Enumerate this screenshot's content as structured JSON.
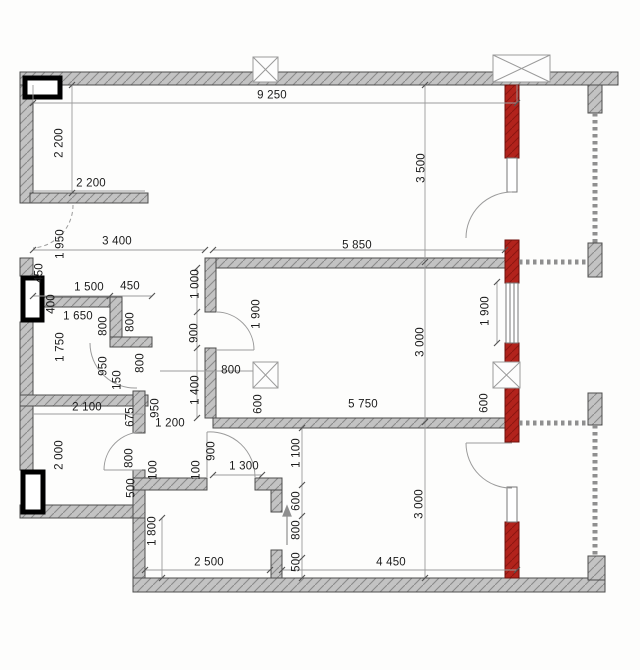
{
  "drawing": {
    "type": "apartment floor plan",
    "units": "millimeters"
  },
  "colors": {
    "wall_fill": "#c3c3c3",
    "wall_hatch": "#8a8a8a",
    "wall_outline": "#4d4d4d",
    "riser_red": "#b2231c",
    "riser_red_hatch": "#8c1510",
    "window_frame": "#000000",
    "dim_line": "#9b9b9b",
    "dim_text": "#1b1b1b",
    "glazing_dot": "#8f8f8f"
  },
  "symbols": {
    "shaft_marker": "x-box",
    "glazing": "dotted-line",
    "entrance": "arrow-up",
    "door_swing": "quarter-arc"
  },
  "dims": {
    "d9250": "9 250",
    "d2200v": "2 200",
    "d2200h": "2 200",
    "d3500": "3 500",
    "d3400": "3 400",
    "d5850": "5 850",
    "d1950": "1 950",
    "d450v": "450",
    "d400": "400",
    "d1500": "1 500",
    "d450h": "450",
    "d1650": "1 650",
    "d800a": "800",
    "d800b": "800",
    "d1750": "1 750",
    "d1000": "1 000",
    "d1900door": "1 900",
    "d900mid": "900",
    "d950a": "950",
    "d150": "150",
    "d800c": "800",
    "d1400": "1 400",
    "d800box": "800",
    "d600mid": "600",
    "d3000a": "3 000",
    "d1900win": "1 900",
    "d600r": "600",
    "d5750": "5 750",
    "d2100": "2 100",
    "d675": "675",
    "d950b": "950",
    "d1200": "1 200",
    "d2000": "2 000",
    "d800d": "800",
    "d500a": "500",
    "d100a": "100",
    "d100b": "100",
    "d900corr": "900",
    "d1300": "1 300",
    "d1100": "1 100",
    "d600b": "600",
    "d800e": "800",
    "d500b": "500",
    "d1800": "1 800",
    "d2500": "2 500",
    "d4450": "4 450",
    "d3000b": "3 000"
  }
}
